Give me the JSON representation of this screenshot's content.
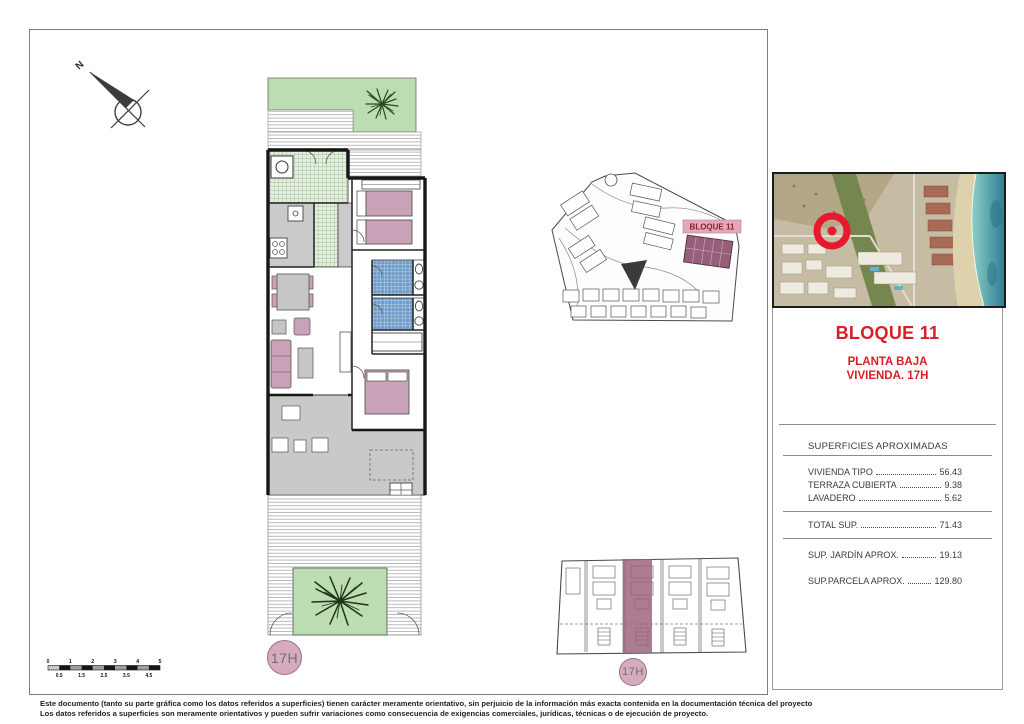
{
  "compass": {
    "north_label": "N"
  },
  "floor_plan": {
    "unit_badge": "17H"
  },
  "site_plan": {
    "block_label": "BLOQUE 11"
  },
  "block_plan": {
    "unit_badge": "17H"
  },
  "title_block": {
    "title": "BLOQUE 11",
    "subtitle_line1": "PLANTA BAJA",
    "subtitle_line2": "VIVIENDA. 17H"
  },
  "surfaces": {
    "header": "SUPERFICIES APROXIMADAS",
    "rows": [
      {
        "label": "VIVIENDA TIPO",
        "value": "56.43"
      },
      {
        "label": "TERRAZA CUBIERTA",
        "value": "9.38"
      },
      {
        "label": "LAVADERO",
        "value": "5.62"
      }
    ],
    "total": {
      "label": "TOTAL SUP.",
      "value": "71.43"
    },
    "extras": [
      {
        "label": "SUP. JARDÍN APROX.",
        "value": "19.13"
      },
      {
        "label": "SUP.PARCELA APROX.",
        "value": "129.80"
      }
    ]
  },
  "scale_bar": {
    "top_labels": [
      "0",
      "1",
      "2",
      "3",
      "4",
      "5"
    ],
    "bottom_labels": [
      "0.5",
      "1.5",
      "2.5",
      "3.5",
      "4.5"
    ]
  },
  "footer": {
    "line1": "Este documento (tanto su parte gráfica como los datos referidos a superficies) tienen carácter meramente orientativo, sin perjuicio de la información más exacta contenida en la documentación técnica del proyecto",
    "line2": "Los datos referidos a superficies son meramente orientativos y pueden sufrir variaciones como consecuencia de exigencias comerciales, jurídicas, técnicas o de ejecución de proyecto."
  },
  "colors": {
    "accent_red": "#d81f26",
    "highlight_mauve": "#96607a",
    "label_pink": "#e3a9b8",
    "badge_pink": "#d7abbe",
    "garden_green": "#bcdcb2",
    "tile_green": "#8db48a",
    "tile_blue": "#6f9dc8",
    "furniture_pink": "#c9a2b8",
    "floor_gray": "#c9c9c9",
    "sea_teal": "#2f7f96"
  }
}
